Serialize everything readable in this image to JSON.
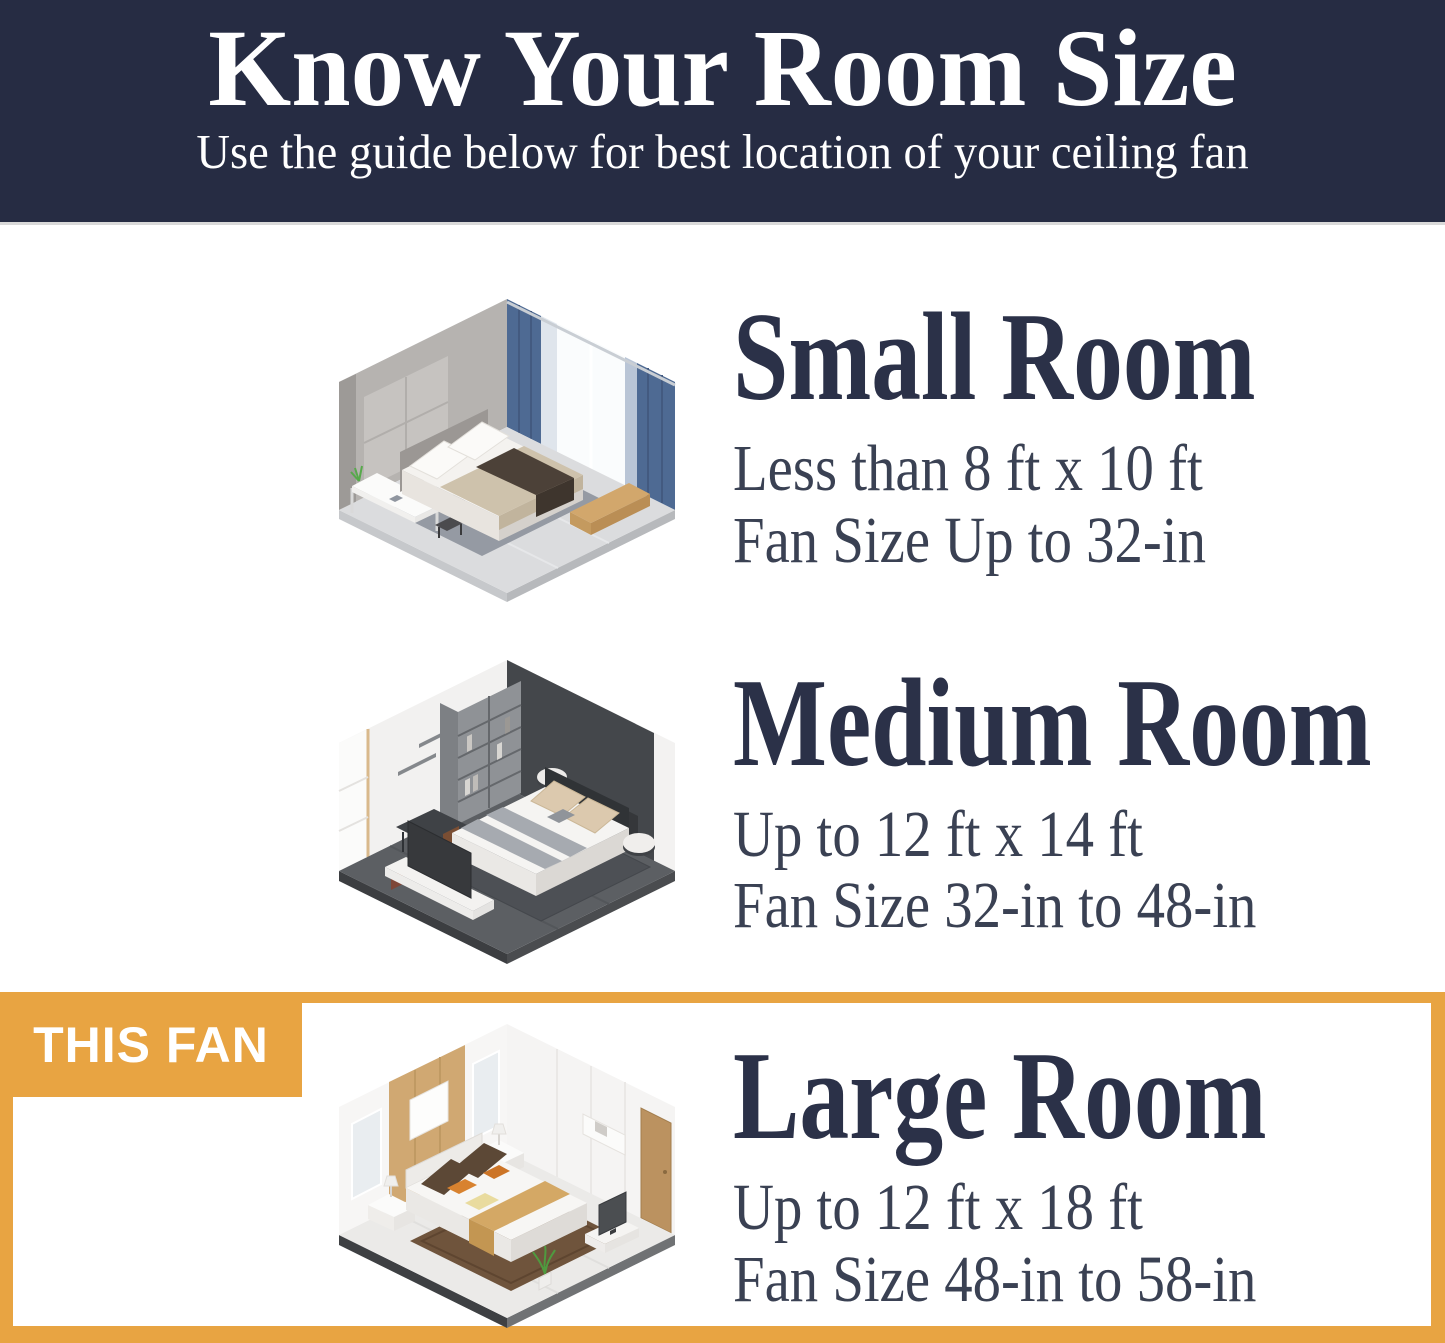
{
  "theme": {
    "navy": "#262c43",
    "heading": "#2b3148",
    "body": "#3a4153",
    "orange": "#e8a442",
    "white": "#ffffff"
  },
  "header": {
    "title": "Know Your Room Size",
    "subtitle": "Use the guide below for best location of your ceiling fan"
  },
  "rooms": [
    {
      "name": "Small Room",
      "dimensions": "Less than 8 ft x 10 ft",
      "fan_size": "Fan Size Up to 32-in",
      "illustration": "small-bedroom-isometric"
    },
    {
      "name": "Medium Room",
      "dimensions": "Up to 12 ft x 14 ft",
      "fan_size": "Fan Size 32-in to 48-in",
      "illustration": "medium-bedroom-isometric"
    },
    {
      "name": "Large Room",
      "dimensions": "Up to 12 ft x 18 ft",
      "fan_size": "Fan Size 48-in to 58-in",
      "illustration": "large-bedroom-isometric",
      "highlighted": true
    }
  ],
  "highlight": {
    "badge_label": "THIS FAN"
  }
}
